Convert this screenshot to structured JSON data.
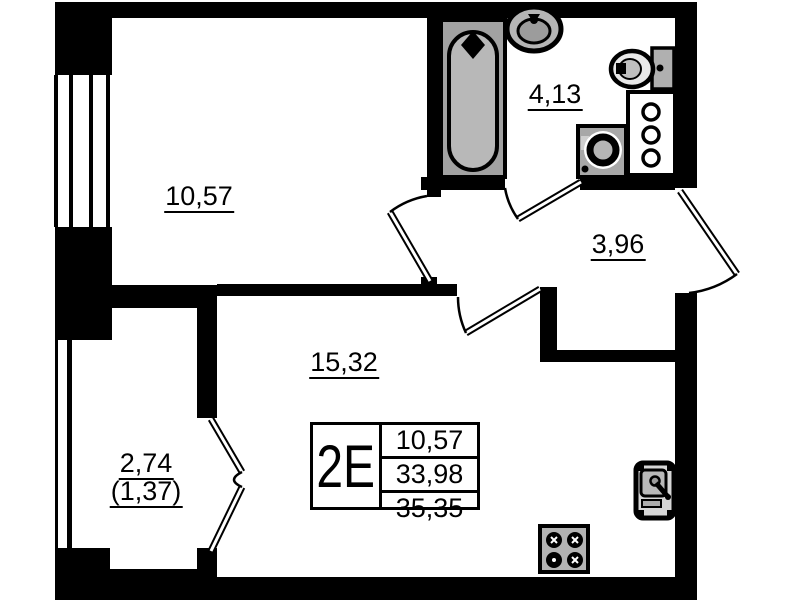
{
  "plan": {
    "title": "apartment floor plan, unit type 2E",
    "summary_table": {
      "type_label": "2E",
      "rows": [
        "10,57",
        "33,98",
        "35,35"
      ]
    },
    "rooms": {
      "bedroom": {
        "area": "10,57"
      },
      "bathroom": {
        "area": "4,13"
      },
      "hallway": {
        "area": "3,96"
      },
      "living": {
        "area": "15,32"
      },
      "balcony": {
        "area": "2,74",
        "area_reduced": "(1,37)"
      }
    },
    "fixtures": [
      "bathtub",
      "wash-basin",
      "toilet",
      "washing-machine",
      "shelf-column",
      "kitchen-sink",
      "stove",
      "entrance-door",
      "bedroom-door",
      "bathroom-door",
      "living-room-door",
      "balcony-french-door",
      "window",
      "balcony-glazing"
    ],
    "colors": {
      "wall": "#000000",
      "background": "#ffffff",
      "fixture_gray": "#a8a8a8",
      "fixture_light_gray": "#bdbdbd"
    }
  }
}
